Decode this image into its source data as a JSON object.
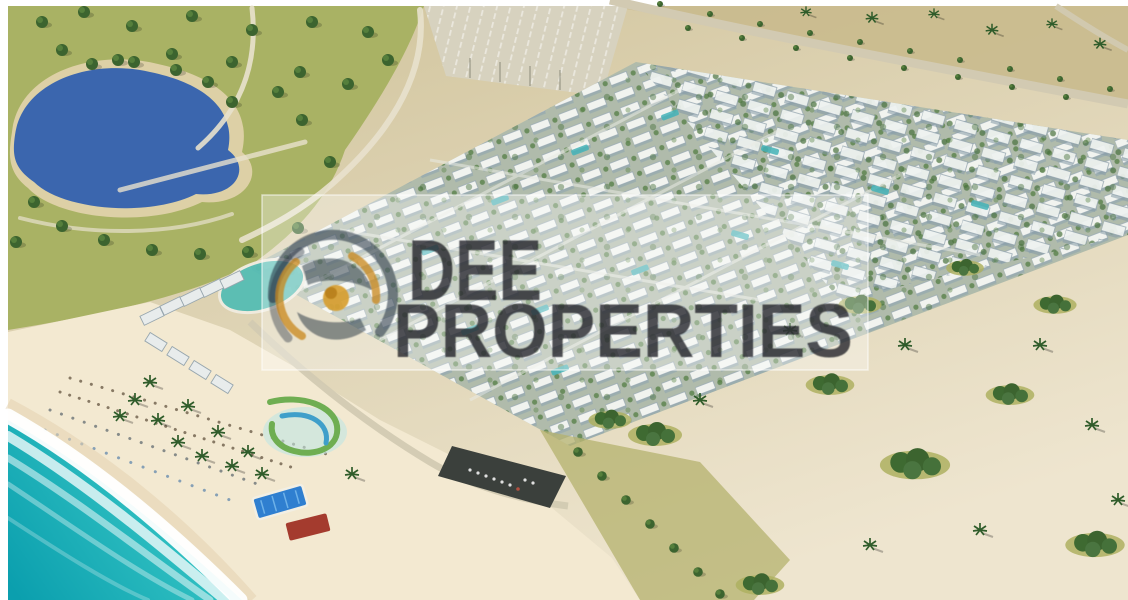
{
  "watermark": {
    "line1": "DEE",
    "line2": "PROPERTIES",
    "box_color": "rgba(255,255,255,0.33)",
    "box_border_color": "rgba(255,255,255,0.55)",
    "text_color": "rgba(24,28,33,0.76)",
    "logo": {
      "ring_color": "#22303e",
      "swirl_color": "#c8871c",
      "center_color": "#d79d2c",
      "center_core_color": "#b87f18"
    }
  },
  "scene": {
    "description_labels": {
      "sea": "turquoise-sea",
      "beach": "sandy-beach",
      "lake": "landscaped-lake",
      "development": "villa-masterplan",
      "waterpark": "aqua-park",
      "desert": "sand-with-palms"
    },
    "colors": {
      "frame": "#ffffff",
      "sand_top": "#cfc299",
      "sand_mid": "#ddd2b2",
      "sand_light": "#eee5cf",
      "sand_far": "#c9ba8d",
      "beach": "#f3e9d1",
      "grass": "#a9b264",
      "olive_patch": "#b4b26e",
      "tree_dark": "#3c642f",
      "lake": "#3b66ae",
      "lake_rim": "#ddd0a6",
      "sea_deep": "#0b9fae",
      "sea_mid": "#2fbfc1",
      "sea_shallow": "#a9ece2",
      "foam": "#ffffff",
      "development_base": "#b0bbab",
      "building_white": "#f4f6f3",
      "building_shadow": "#8ea3b0",
      "pool_teal": "#45b3b8",
      "pool_blue": "#2f7fd0",
      "road": "#d2cab2",
      "path": "#e8e1cd",
      "structure_dark": "#3b403c",
      "pavilion_red": "#a43b2e",
      "slide_green": "#6fae52",
      "slide_blue": "#3f9fca"
    }
  }
}
